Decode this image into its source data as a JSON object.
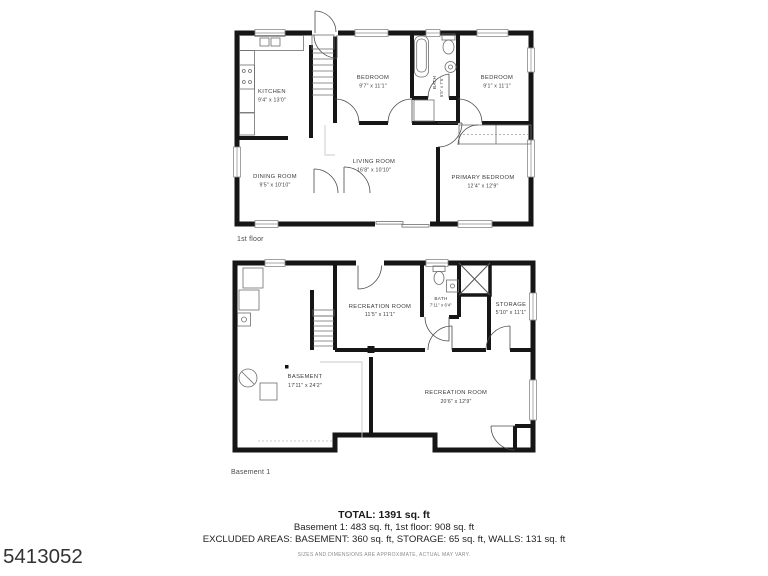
{
  "photo_id": "5413052",
  "colors": {
    "wall": "#161616",
    "label": "#3a3a3a",
    "background": "#ffffff"
  },
  "floors": {
    "first": {
      "caption": "1st floor",
      "rooms": {
        "kitchen": {
          "name": "KITCHEN",
          "dims": "9'4\" x 13'0\""
        },
        "bedroom1": {
          "name": "BEDROOM",
          "dims": "9'7\" x 11'1\""
        },
        "bath": {
          "name": "BATH",
          "dims": "6'5\" x 7'6\""
        },
        "bedroom2": {
          "name": "BEDROOM",
          "dims": "9'1\" x 11'1\""
        },
        "dining": {
          "name": "DINING ROOM",
          "dims": "9'5\" x 10'10\""
        },
        "living": {
          "name": "LIVING ROOM",
          "dims": "16'8\" x 10'10\""
        },
        "primary": {
          "name": "PRIMARY BEDROOM",
          "dims": "12'4\" x 12'9\""
        }
      }
    },
    "basement": {
      "caption": "Basement 1",
      "rooms": {
        "rec1": {
          "name": "RECREATION ROOM",
          "dims": "11'5\" x 11'1\""
        },
        "bath": {
          "name": "BATH",
          "dims": "7'11\" x 6'4\""
        },
        "storage": {
          "name": "STORAGE",
          "dims": "5'10\" x 11'1\""
        },
        "basement": {
          "name": "BASEMENT",
          "dims": "17'11\" x 24'2\""
        },
        "rec2": {
          "name": "RECREATION ROOM",
          "dims": "20'6\" x 12'9\""
        }
      }
    }
  },
  "summary": {
    "total": "TOTAL: 1391 sq. ft",
    "floors_line": "Basement 1: 483 sq. ft, 1st floor: 908 sq. ft",
    "excluded_line": "EXCLUDED AREAS: BASEMENT: 360 sq. ft, STORAGE: 65 sq. ft, WALLS: 131 sq. ft",
    "disclaimer": "SIZES AND DIMENSIONS ARE APPROXIMATE, ACTUAL MAY VARY."
  }
}
